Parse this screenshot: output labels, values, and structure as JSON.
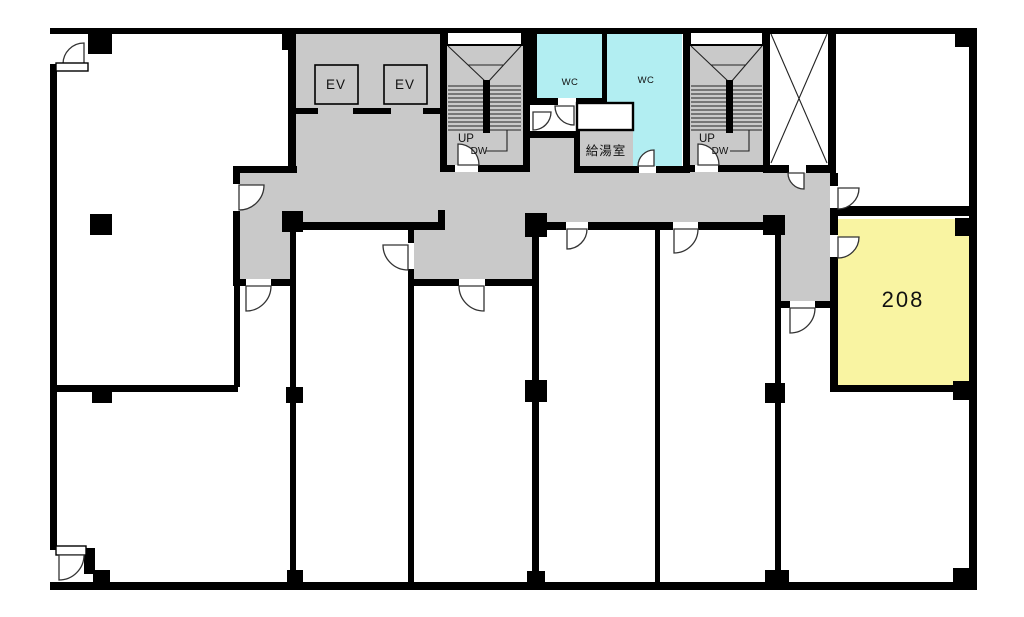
{
  "plan": {
    "name": "building-floor-plan-2f",
    "labels": {
      "elevator1": "EV",
      "elevator2": "EV",
      "wc1": "WC",
      "wc2": "WC",
      "stair1_up": "UP",
      "stair1_down": "DW",
      "stair2_up": "UP",
      "stair2_down": "DW",
      "kitchenette": "給湯室",
      "room208": "208"
    },
    "colors": {
      "corridor": "#c9c9c9",
      "wc": "#b2eef2",
      "room_available": "#f9f4a2",
      "wall": "#000000",
      "background": "#ffffff"
    }
  }
}
